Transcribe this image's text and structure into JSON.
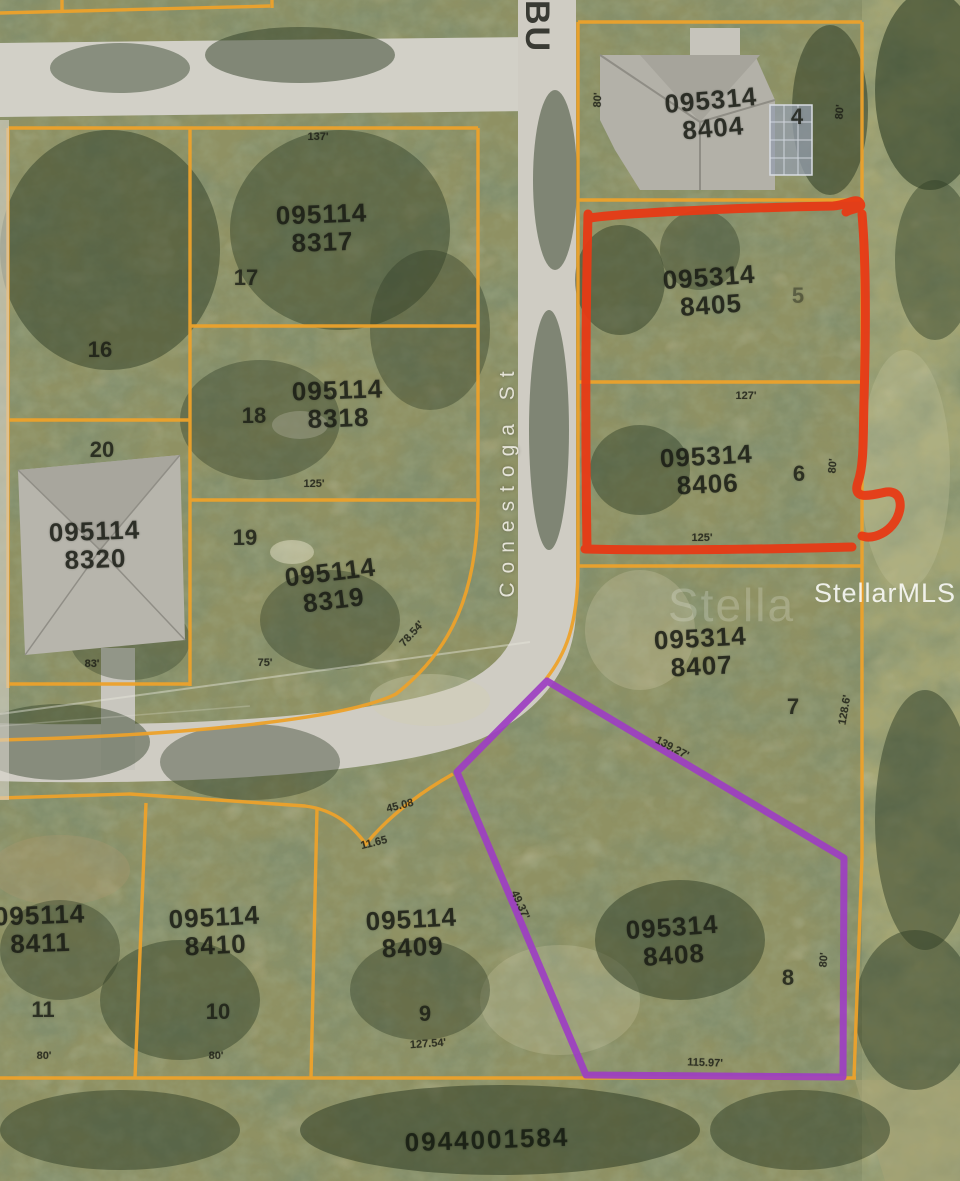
{
  "map": {
    "title": "Aerial parcel map",
    "streets": {
      "vertical": "Conestoga St",
      "top_partial": "BU"
    },
    "watermark": {
      "main": "StellarMLS",
      "ghost": "Stella"
    },
    "parcels": [
      {
        "id_line1": "095114",
        "id_line2": "8317",
        "lot": "17"
      },
      {
        "id_line1": "095114",
        "id_line2": "8318",
        "lot": "18"
      },
      {
        "id_line1": "095114",
        "id_line2": "8319",
        "lot": "19"
      },
      {
        "id_line1": "095114",
        "id_line2": "8320",
        "lot": "20"
      },
      {
        "lot": "16"
      },
      {
        "id_line1": "095314",
        "id_line2": "8404",
        "lot": "4"
      },
      {
        "id_line1": "095314",
        "id_line2": "8405",
        "lot": "5",
        "highlight": "red"
      },
      {
        "id_line1": "095314",
        "id_line2": "8406",
        "lot": "6",
        "highlight": "red"
      },
      {
        "id_line1": "095314",
        "id_line2": "8407",
        "lot": "7"
      },
      {
        "id_line1": "095314",
        "id_line2": "8408",
        "lot": "8",
        "highlight": "purple"
      },
      {
        "id_line1": "095114",
        "id_line2": "8409",
        "lot": "9"
      },
      {
        "id_line1": "095114",
        "id_line2": "8410",
        "lot": "10"
      },
      {
        "id_line1": "095114",
        "id_line2": "8411",
        "lot": "11"
      }
    ],
    "bottom_parcel_id": "0944001584",
    "dims": [
      {
        "text": "80'"
      },
      {
        "text": "80'"
      },
      {
        "text": "127'"
      },
      {
        "text": "80'"
      },
      {
        "text": "125'"
      },
      {
        "text": "128.6'"
      },
      {
        "text": "139.27'"
      },
      {
        "text": "49.37'"
      },
      {
        "text": "115.97'"
      },
      {
        "text": "127.54'"
      },
      {
        "text": "80'"
      },
      {
        "text": "80'"
      },
      {
        "text": "75'"
      },
      {
        "text": "78.54'"
      },
      {
        "text": "83'"
      },
      {
        "text": "137'"
      },
      {
        "text": "125'"
      },
      {
        "text": "45.08"
      },
      {
        "text": "11.65"
      },
      {
        "text": "80'"
      }
    ],
    "colors": {
      "parcel_line": "#EDA22B",
      "red_outline": "#E73A15",
      "purple_outline": "#9D3EC2",
      "road": "#D2D0C7",
      "ground": "#8F9163",
      "street_label": "#EEECE2"
    }
  }
}
